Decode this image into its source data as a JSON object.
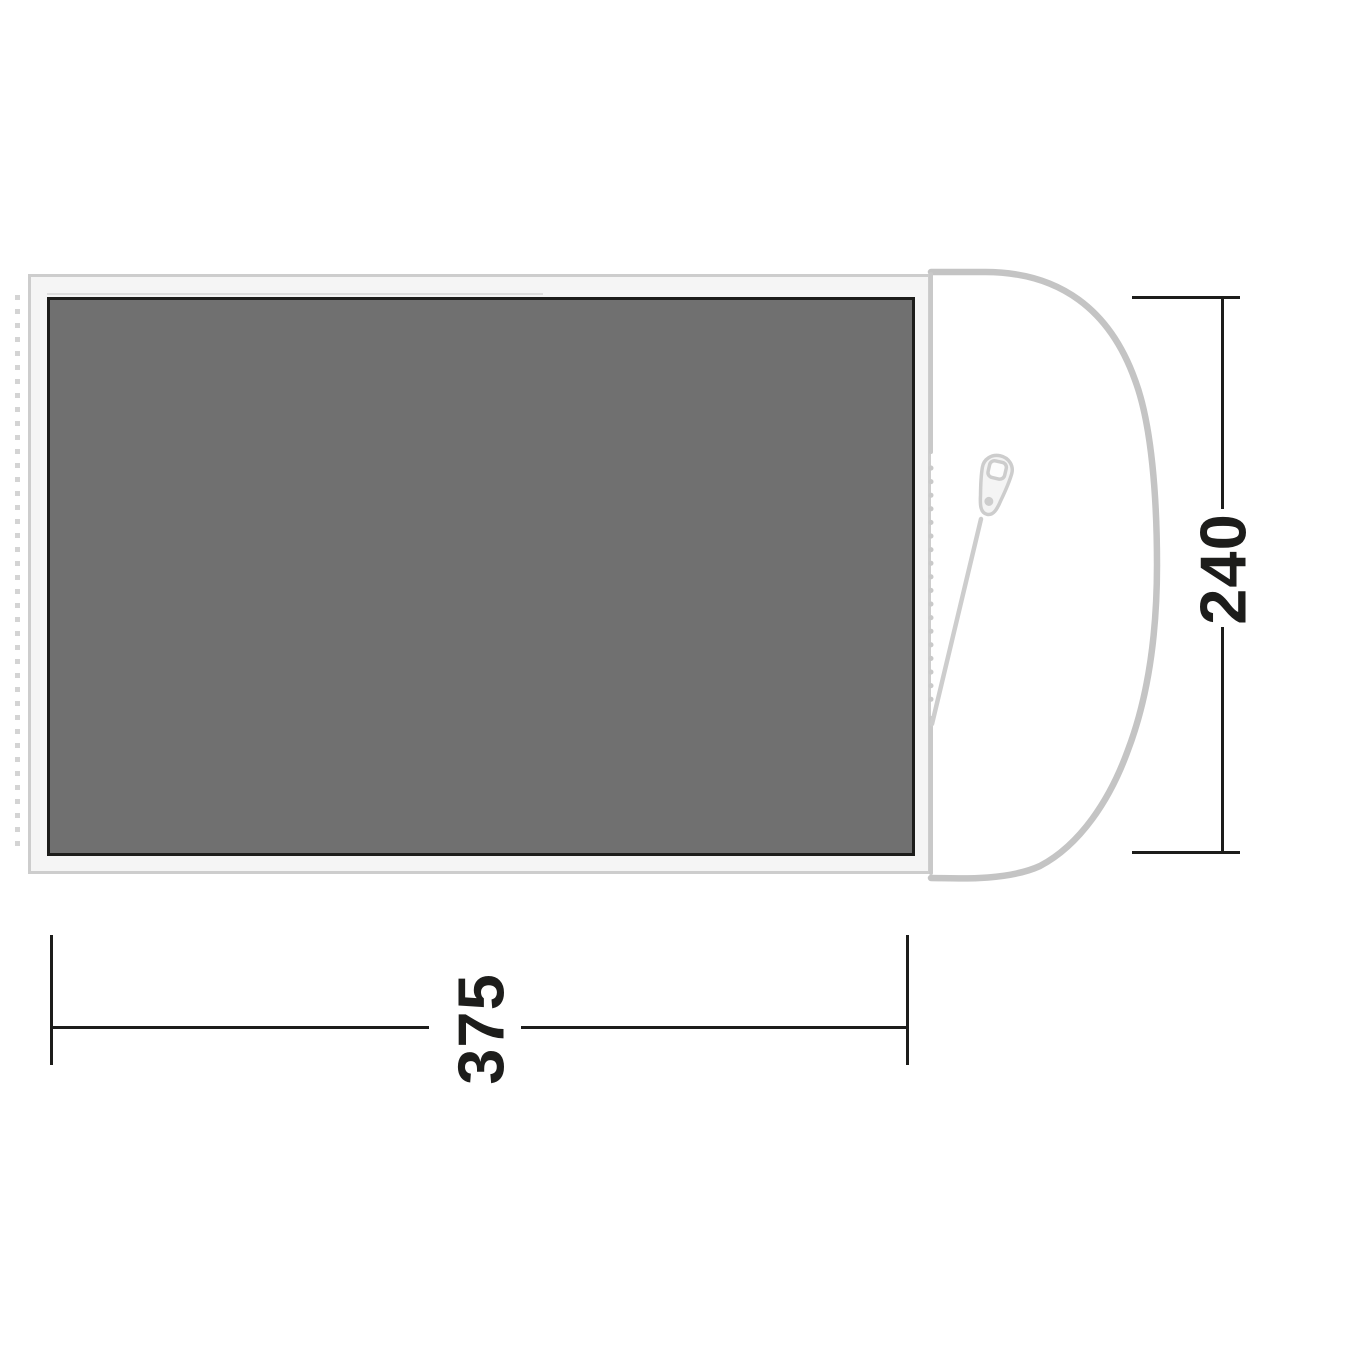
{
  "floorplan": {
    "dimension_width_label": "375",
    "dimension_height_label": "240",
    "icons": {
      "zipper": "zipper-pull-icon"
    },
    "colors": {
      "dimension": "#1d1d1b",
      "groundsheet_fill": "#707070",
      "groundsheet_border": "#1d1d1b",
      "canvas_fill": "#f5f5f5",
      "canvas_border": "#cdcdcd",
      "door_outline": "#c4c4c4",
      "door_edge": "#c9c9c9",
      "zipper_fill": "#f4f4f4",
      "zipper_stroke": "#cdcdcd",
      "zipper_hole": "#fcfcfc",
      "peg_dot": "#d4d4d4",
      "seam": "#dedede"
    }
  }
}
